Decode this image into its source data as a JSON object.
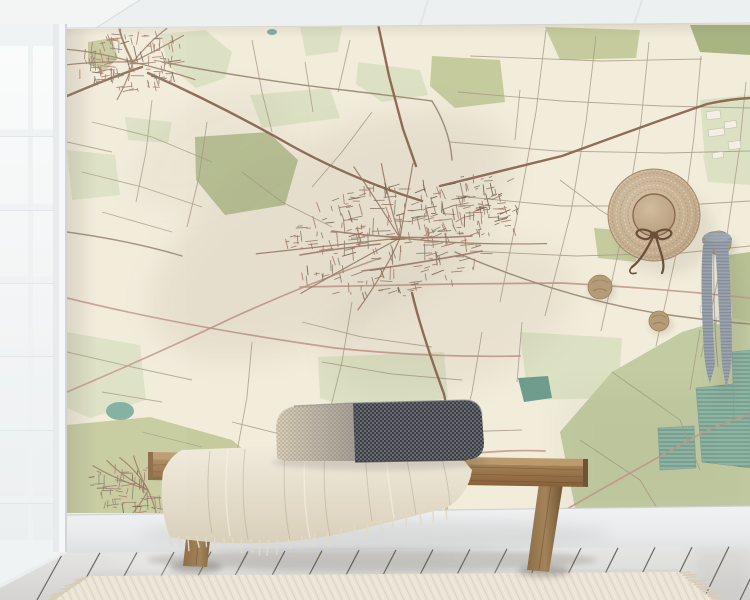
{
  "scene": {
    "description": "Product mockup photo: vintage street-map wall mural in a bright room with white ceiling, white french window at left, whitewashed plank floor, striped runner rug, wooden bench with two-tone lumbar pillow and cream fringed throw, straw hat and grey striped scarf hanging on round wooden wall hooks",
    "canvas": {
      "width": 750,
      "height": 600
    }
  },
  "palette": {
    "ceiling": "#edf0f0",
    "window_frame": "#f0f3f4",
    "glass_top": "#fafbfb",
    "glass_bottom": "#eceff0",
    "map_bg": "#f2ecda",
    "field_line": "#a89c88",
    "road_salmon": "#c49a8c",
    "road_medium": "#9b8a76",
    "road_major": "#8a6550",
    "road_arterial": "#a4756a",
    "road_village": "#9c7a62",
    "street_grey": "#8c8172",
    "street_brick": "#ad7a6b",
    "street_dark": "#6f5d4a",
    "green_olive": "#c6cb9e",
    "green_pale": "#dde1c3",
    "green_sage": "#b9c295",
    "green_darkolive": "#a9b483",
    "green_big": "#c2cba1",
    "teal_lake": "#7fae9e",
    "teal_dark": "#6e9d8d",
    "baseboard_top": "#f0f1f2",
    "baseboard_bottom": "#dfe1e3",
    "floor_light": "#e3e3e1",
    "floor_dark": "#d6d5d3",
    "rug_base": "#e9e3d4",
    "rug_stripe": "#d7cfbc",
    "wood_light": "#b08d60",
    "wood_mid": "#96764c",
    "wood_dark": "#6f5534",
    "blanket_light": "#f1ebdd",
    "blanket_dark": "#ded5c0",
    "pillow_light": "#cfc5b1",
    "pillow_dark": "#55575c",
    "hat_straw": "#c3ad8e",
    "hat_ribbon": "#6b4f38",
    "hook_wood": "#b59c79",
    "scarf_base": "#9aa3ad",
    "scarf_stripe": "#7d8793"
  },
  "mural": {
    "background": "#f2ecda",
    "green_patches": [
      {
        "points": "88,42 112,38 118,58 104,72 88,64",
        "fill": "green_olive"
      },
      {
        "points": "160,34 205,30 232,52 225,78 196,88 168,66",
        "fill": "green_pale"
      },
      {
        "points": "300,27 342,27 338,52 306,56",
        "fill": "green_pale"
      },
      {
        "points": "358,62 420,70 428,95 382,102 356,84",
        "fill": "green_pale"
      },
      {
        "points": "432,56 500,60 505,102 455,108 430,86",
        "fill": "green_olive"
      },
      {
        "points": "545,27 640,30 636,58 560,60",
        "fill": "green_olive"
      },
      {
        "points": "690,25 750,25 750,55 700,52",
        "fill": "green_darkolive"
      },
      {
        "points": "700,100 750,95 750,180 706,172",
        "fill": "green_pale"
      },
      {
        "points": "195,137 268,132 298,160 285,205 225,215 196,180",
        "fill": "green_sage"
      },
      {
        "points": "67,150 115,155 120,195 72,200",
        "fill": "green_pale"
      },
      {
        "points": "125,117 172,122 168,143 128,140",
        "fill": "green_pale"
      },
      {
        "points": "250,95 330,88 340,118 262,128",
        "fill": "green_pale"
      },
      {
        "points": "67,332 140,345 146,400 90,418 67,408",
        "fill": "green_pale"
      },
      {
        "points": "67,425 150,417 232,440 266,468 254,513 67,513",
        "fill": "green_olive"
      },
      {
        "points": "318,357 444,352 448,398 360,412 320,398",
        "fill": "green_pale"
      },
      {
        "points": "520,332 622,338 618,398 528,400",
        "fill": "green_pale"
      },
      {
        "points": "560,432 612,372 682,332 750,312 750,513 576,513",
        "fill": "green_big"
      },
      {
        "points": "728,255 750,252 750,322 732,318",
        "fill": "green_sage"
      },
      {
        "points": "703,155 750,152 750,185 708,182",
        "fill": "green_pale"
      },
      {
        "points": "594,228 640,232 636,262 598,258",
        "fill": "green_olive"
      }
    ],
    "lakes": [
      {
        "type": "ellipse",
        "cx": 120,
        "cy": 411,
        "rx": 14,
        "ry": 9,
        "fill": "#7fae9e"
      },
      {
        "type": "polygon",
        "points": "518,378 548,376 552,398 524,402",
        "fill": "#6e9d8d"
      },
      {
        "type": "ellipse",
        "cx": 272,
        "cy": 32,
        "rx": 5,
        "ry": 3,
        "fill": "#7fae9e"
      }
    ],
    "marsh_areas": [
      "696,388 750,382 750,468 702,462",
      "658,428 694,426 696,468 660,470",
      "732,352 750,350 750,420 734,418"
    ],
    "field_lines": [
      "M500,302 L521,196 L536,112 L546,30",
      "M545,316 L571,212 L586,122 L596,36",
      "M601,331 L626,216 L641,122 L649,42",
      "M656,346 L681,232 L694,137 L701,56",
      "M701,357 L726,242 L739,152 L746,82",
      "M458,92 L562,101 L662,106 L750,108",
      "M450,142 L556,151 L666,153 L750,151",
      "M456,196 L562,206 L669,206 L750,201",
      "M470,251 L576,256 L682,253 L750,246",
      "M470,56 L602,61 L702,59",
      "M350,40 L338,92",
      "M305,62 L313,112",
      "M252,40 L262,92 L272,132",
      "M92,122 L152,137 L212,162",
      "M82,172 L142,187 L202,207",
      "M102,212 L172,232",
      "M152,100 L146,152 L136,202",
      "M207,122 L199,177 L187,227",
      "M67,142 L112,152",
      "M242,172 L282,202 L332,227",
      "M372,112 L342,152 L312,187",
      "M302,322 L362,337 L432,347",
      "M322,362 L392,374 L462,380",
      "M482,332 L472,392 L462,432",
      "M522,322 L517,382",
      "M352,302 L342,362 L327,422",
      "M252,342 L247,397 L237,452",
      "M382,422 L452,432 L522,430",
      "M302,432 L372,444",
      "M67,352 L132,367 L192,380",
      "M102,392 L162,402",
      "M142,432 L202,447",
      "M232,422 L292,437",
      "M612,372 L680,420 L700,470",
      "M580,440 L640,480 L660,513",
      "M700,330 L690,390",
      "M560,180 L600,210 L640,235",
      "M520,90 L515,140"
    ],
    "salmon_roads": [
      "M67,298 Q180,326 335,348 Q430,358 520,356",
      "M300,287 L455,284 L562,283 Q655,288 750,298",
      "M380,258 Q302,286 232,318 Q152,356 67,392",
      "M560,513 Q642,466 702,433 Q727,421 750,415",
      "M282,502 Q362,472 452,456 Q502,449 545,451"
    ],
    "medium_roads": [
      "M455,252 Q562,298 662,314 Q712,321 750,324",
      "M162,62 Q262,81 352,91 Q402,97 432,101",
      "M432,101 Q450,130 452,160",
      "M67,232 Q132,241 182,256"
    ],
    "major_roads": [
      "M67,96 Q112,77 142,67",
      "M148,73 Q222,106 292,146 Q352,179 422,201",
      "M440,186 Q502,171 562,156 Q652,123 707,104 Q730,99 750,98",
      "M412,293 Q421,331 444,394 Q453,431 448,472 L446,513",
      "M378,24 L389,76 L403,129 L416,166"
    ],
    "arterial_roads": [
      "M332,231 Q402,241 472,236",
      "M362,271 Q422,263 482,251",
      "M300,255 Q340,248 380,244"
    ],
    "buildings": [
      {
        "x": 706,
        "y": 112,
        "w": 14,
        "h": 8
      },
      {
        "x": 724,
        "y": 122,
        "w": 12,
        "h": 7
      },
      {
        "x": 708,
        "y": 130,
        "w": 16,
        "h": 7
      },
      {
        "x": 728,
        "y": 142,
        "w": 12,
        "h": 8
      },
      {
        "x": 712,
        "y": 153,
        "w": 11,
        "h": 6
      },
      {
        "x": 700,
        "y": 306,
        "w": 12,
        "h": 7
      },
      {
        "x": 716,
        "y": 318,
        "w": 14,
        "h": 7
      },
      {
        "x": 704,
        "y": 333,
        "w": 10,
        "h": 6
      }
    ],
    "towns": [
      {
        "cx": 400,
        "cy": 238,
        "rx": 118,
        "ry": 58,
        "rot": -8,
        "count": 250,
        "rays": 7,
        "seed": 7
      },
      {
        "cx": 468,
        "cy": 208,
        "rx": 56,
        "ry": 33,
        "rot": -15,
        "count": 90,
        "rays": 0,
        "seed": 11
      },
      {
        "cx": 133,
        "cy": 62,
        "rx": 56,
        "ry": 30,
        "rot": -5,
        "count": 120,
        "rays": 8,
        "seed": 3
      },
      {
        "cx": 148,
        "cy": 490,
        "rx": 62,
        "ry": 27,
        "rot": 3,
        "count": 95,
        "rays": 6,
        "seed": 5
      }
    ]
  },
  "decor": {
    "hat": {
      "cx": 654,
      "cy": 215,
      "brim_radius": 46,
      "crown_radius": 21
    },
    "hooks": [
      {
        "cx": 600,
        "cy": 287,
        "r": 12
      },
      {
        "cx": 659,
        "cy": 321,
        "r": 10
      },
      {
        "cx": 719,
        "cy": 243,
        "r": 12
      }
    ],
    "scarf": {
      "x": 719,
      "y": 247,
      "length": 140
    }
  },
  "furniture": {
    "bench": {
      "left": 148,
      "right": 588,
      "seat_top": 452,
      "seat_bottom": 487
    },
    "pillow": {
      "left": 276,
      "right": 484,
      "seam_x": 353
    },
    "blanket": {
      "fringe_count": 26
    },
    "rug": {
      "fringe_count": 13,
      "seed": 21
    }
  },
  "room": {
    "floor": {
      "seam_spacing": 37
    }
  }
}
